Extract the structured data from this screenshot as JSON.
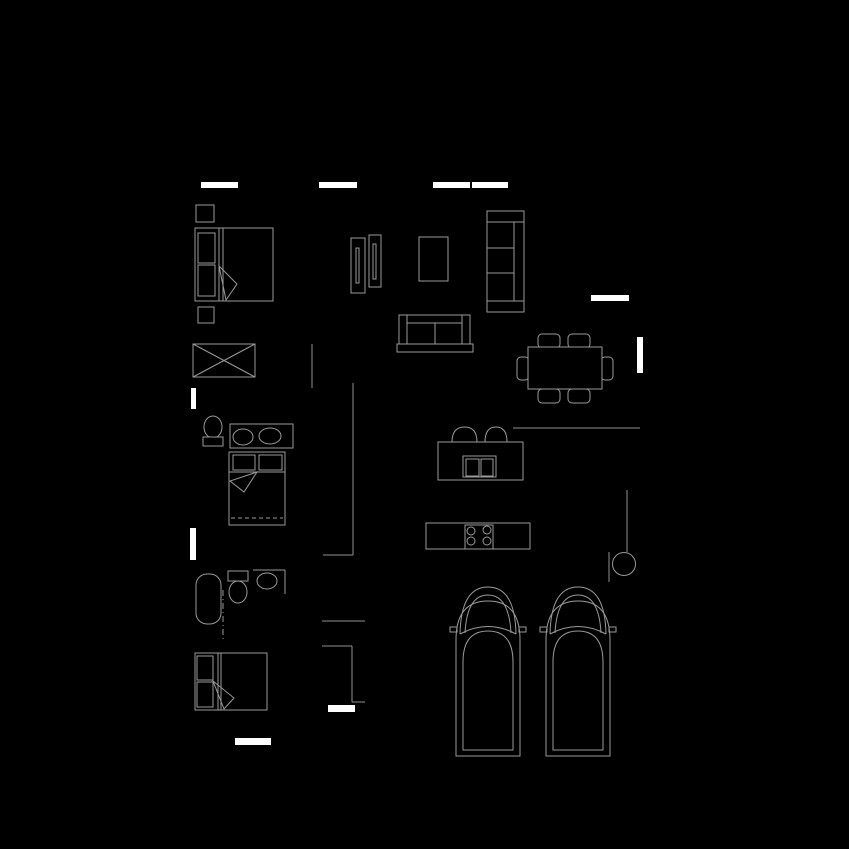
{
  "canvas": {
    "w": 849,
    "h": 849,
    "bg": "#000000"
  },
  "palette": {
    "wall_line": "#8f8f8f",
    "furniture_line": "#9a9a9a",
    "window_fill": "#ffffff",
    "occlusion_fill": "#000000"
  },
  "layers": [
    {
      "name": "walls",
      "stroke": "#8f8f8f",
      "items": [
        {
          "kind": "line",
          "name": "wall-bedroom1-stub",
          "x1": 312,
          "y1": 344,
          "x2": 312,
          "y2": 388
        },
        {
          "kind": "line",
          "name": "wall-hall-vertical",
          "x1": 353,
          "y1": 383,
          "x2": 353,
          "y2": 555
        },
        {
          "kind": "line",
          "name": "wall-hall-corner",
          "x1": 323,
          "y1": 555,
          "x2": 353,
          "y2": 555
        },
        {
          "kind": "line",
          "name": "wall-hall-lower-1",
          "x1": 322,
          "y1": 621,
          "x2": 365,
          "y2": 621
        },
        {
          "kind": "line",
          "name": "wall-hall-lower-2",
          "x1": 322,
          "y1": 646,
          "x2": 352,
          "y2": 646
        },
        {
          "kind": "line",
          "name": "wall-hall-lower-3",
          "x1": 352,
          "y1": 646,
          "x2": 352,
          "y2": 702
        },
        {
          "kind": "line",
          "name": "wall-hall-lower-4",
          "x1": 352,
          "y1": 702,
          "x2": 365,
          "y2": 702
        },
        {
          "kind": "line",
          "name": "wall-dining-bottom",
          "x1": 513,
          "y1": 428,
          "x2": 640,
          "y2": 428
        },
        {
          "kind": "line",
          "name": "wall-utility-vertical",
          "x1": 627,
          "y1": 490,
          "x2": 627,
          "y2": 552
        },
        {
          "kind": "line",
          "name": "wall-utility-short",
          "x1": 609,
          "y1": 552,
          "x2": 609,
          "y2": 582
        }
      ]
    },
    {
      "name": "furniture",
      "stroke": "#9a9a9a",
      "items": [
        {
          "kind": "rect",
          "name": "nightstand-1",
          "x": 196,
          "y": 205,
          "w": 18,
          "h": 17
        },
        {
          "kind": "rect",
          "name": "master-bed-frame",
          "x": 195,
          "y": 228,
          "w": 78,
          "h": 73,
          "fill": "dark"
        },
        {
          "kind": "rect",
          "name": "master-bed-pillow-1",
          "x": 198,
          "y": 233,
          "w": 17,
          "h": 30
        },
        {
          "kind": "rect",
          "name": "master-bed-pillow-2",
          "x": 198,
          "y": 265,
          "w": 17,
          "h": 31
        },
        {
          "kind": "line",
          "name": "master-bed-blanket-line-1",
          "x1": 219,
          "y1": 228,
          "x2": 219,
          "y2": 301
        },
        {
          "kind": "line",
          "name": "master-bed-blanket-line-2",
          "x1": 223,
          "y1": 228,
          "x2": 223,
          "y2": 301
        },
        {
          "kind": "polygon",
          "name": "master-bed-fold",
          "points": "219,266 237,284 226,300"
        },
        {
          "kind": "rect",
          "name": "nightstand-2",
          "x": 198,
          "y": 307,
          "w": 16,
          "h": 16
        },
        {
          "kind": "rect",
          "name": "wardrobe",
          "x": 193,
          "y": 344,
          "w": 62,
          "h": 33
        },
        {
          "kind": "line",
          "name": "wardrobe-diagonal-1",
          "x1": 193,
          "y1": 344,
          "x2": 255,
          "y2": 377
        },
        {
          "kind": "line",
          "name": "wardrobe-diagonal-2",
          "x1": 255,
          "y1": 344,
          "x2": 193,
          "y2": 377
        },
        {
          "kind": "rect",
          "name": "media-panel-1",
          "x": 351,
          "y": 238,
          "w": 14,
          "h": 55
        },
        {
          "kind": "rect",
          "name": "media-panel-1-slit",
          "x": 356,
          "y": 248,
          "w": 3,
          "h": 35
        },
        {
          "kind": "rect",
          "name": "media-panel-2",
          "x": 369,
          "y": 235,
          "w": 12,
          "h": 52
        },
        {
          "kind": "rect",
          "name": "media-panel-2-slit",
          "x": 373,
          "y": 244,
          "w": 3,
          "h": 35
        },
        {
          "kind": "rect",
          "name": "armchair-table",
          "x": 419,
          "y": 237,
          "w": 29,
          "h": 44
        },
        {
          "kind": "rect",
          "name": "sofa-horizontal-base",
          "x": 397,
          "y": 344,
          "w": 76,
          "h": 8
        },
        {
          "kind": "rect",
          "name": "sofa-horizontal-body",
          "x": 399,
          "y": 315,
          "w": 71,
          "h": 29,
          "fill": "dark"
        },
        {
          "kind": "line",
          "name": "sofa-horizontal-arm-left",
          "x1": 407,
          "y1": 315,
          "x2": 407,
          "y2": 344
        },
        {
          "kind": "line",
          "name": "sofa-horizontal-arm-right",
          "x1": 462,
          "y1": 315,
          "x2": 462,
          "y2": 344
        },
        {
          "kind": "line",
          "name": "sofa-horizontal-backline",
          "x1": 407,
          "y1": 323,
          "x2": 462,
          "y2": 323
        },
        {
          "kind": "line",
          "name": "sofa-horizontal-cushion-divider",
          "x1": 435,
          "y1": 323,
          "x2": 435,
          "y2": 344
        },
        {
          "kind": "rect",
          "name": "sofa-vertical-body",
          "x": 487,
          "y": 211,
          "w": 37,
          "h": 101,
          "fill": "dark"
        },
        {
          "kind": "line",
          "name": "sofa-vertical-arm-top",
          "x1": 487,
          "y1": 222,
          "x2": 524,
          "y2": 222
        },
        {
          "kind": "line",
          "name": "sofa-vertical-arm-bottom",
          "x1": 487,
          "y1": 301,
          "x2": 524,
          "y2": 301
        },
        {
          "kind": "line",
          "name": "sofa-vertical-backline",
          "x1": 514,
          "y1": 222,
          "x2": 514,
          "y2": 301
        },
        {
          "kind": "line",
          "name": "sofa-vertical-cushion-1",
          "x1": 487,
          "y1": 248,
          "x2": 514,
          "y2": 248
        },
        {
          "kind": "line",
          "name": "sofa-vertical-cushion-2",
          "x1": 487,
          "y1": 273,
          "x2": 514,
          "y2": 273
        },
        {
          "kind": "rect",
          "name": "dining-chair-top-1",
          "x": 538,
          "y": 334,
          "w": 22,
          "h": 14,
          "rx": 4
        },
        {
          "kind": "rect",
          "name": "dining-chair-top-2",
          "x": 568,
          "y": 334,
          "w": 22,
          "h": 14,
          "rx": 4
        },
        {
          "kind": "rect",
          "name": "dining-chair-bottom-1",
          "x": 538,
          "y": 389,
          "w": 22,
          "h": 14,
          "rx": 4
        },
        {
          "kind": "rect",
          "name": "dining-chair-bottom-2",
          "x": 568,
          "y": 389,
          "w": 22,
          "h": 14,
          "rx": 4
        },
        {
          "kind": "rect",
          "name": "dining-chair-left",
          "x": 517,
          "y": 357,
          "w": 12,
          "h": 23,
          "rx": 4
        },
        {
          "kind": "rect",
          "name": "dining-chair-right",
          "x": 601,
          "y": 357,
          "w": 12,
          "h": 23,
          "rx": 4
        },
        {
          "kind": "rect",
          "name": "dining-table",
          "x": 528,
          "y": 347,
          "w": 74,
          "h": 42,
          "fill": "dark"
        },
        {
          "kind": "ellipse",
          "name": "toilet-2-bowl",
          "cx": 213,
          "cy": 427,
          "rx": 9,
          "ry": 11
        },
        {
          "kind": "rect",
          "name": "toilet-2-tank",
          "x": 203,
          "y": 437,
          "w": 20,
          "h": 9,
          "fill": "dark"
        },
        {
          "kind": "rect",
          "name": "vanity-counter",
          "x": 230,
          "y": 424,
          "w": 63,
          "h": 24
        },
        {
          "kind": "ellipse",
          "name": "vanity-sink-1",
          "cx": 243,
          "cy": 437,
          "rx": 10,
          "ry": 8
        },
        {
          "kind": "ellipse",
          "name": "vanity-sink-2",
          "cx": 270,
          "cy": 436,
          "rx": 11,
          "ry": 8
        },
        {
          "kind": "rect",
          "name": "bed2-frame",
          "x": 229,
          "y": 452,
          "w": 56,
          "h": 73,
          "fill": "dark"
        },
        {
          "kind": "rect",
          "name": "bed2-pillow-1",
          "x": 233,
          "y": 455,
          "w": 22,
          "h": 15
        },
        {
          "kind": "rect",
          "name": "bed2-pillow-2",
          "x": 259,
          "y": 455,
          "w": 23,
          "h": 15
        },
        {
          "kind": "line",
          "name": "bed2-blanket-line",
          "x1": 229,
          "y1": 472,
          "x2": 285,
          "y2": 472
        },
        {
          "kind": "polygon",
          "name": "bed2-fold",
          "points": "257,472 230,481 244,492"
        },
        {
          "kind": "line",
          "name": "bed2-hem-dashed",
          "x1": 231,
          "y1": 518,
          "x2": 283,
          "y2": 518,
          "dash": "4 3"
        },
        {
          "kind": "rect",
          "name": "bathtub",
          "x": 196,
          "y": 574,
          "w": 25,
          "h": 50,
          "rx": 11
        },
        {
          "kind": "line",
          "name": "bathroom-divider",
          "x1": 223,
          "y1": 590,
          "x2": 223,
          "y2": 640,
          "dash": "6 3 1 3"
        },
        {
          "kind": "rect",
          "name": "toilet-3-tank",
          "x": 228,
          "y": 571,
          "w": 20,
          "h": 10
        },
        {
          "kind": "ellipse",
          "name": "toilet-3-bowl",
          "cx": 238,
          "cy": 592,
          "rx": 9,
          "ry": 11
        },
        {
          "kind": "line",
          "name": "corner-sink-counter-top",
          "x1": 253,
          "y1": 570,
          "x2": 285,
          "y2": 570
        },
        {
          "kind": "line",
          "name": "corner-sink-counter-side",
          "x1": 285,
          "y1": 570,
          "x2": 285,
          "y2": 594
        },
        {
          "kind": "ellipse",
          "name": "corner-sink-basin",
          "cx": 267,
          "cy": 581,
          "rx": 10,
          "ry": 8
        },
        {
          "kind": "rect",
          "name": "bed3-frame",
          "x": 195,
          "y": 653,
          "w": 72,
          "h": 57,
          "fill": "dark"
        },
        {
          "kind": "rect",
          "name": "bed3-pillow-1",
          "x": 197,
          "y": 656,
          "w": 16,
          "h": 24
        },
        {
          "kind": "rect",
          "name": "bed3-pillow-2",
          "x": 197,
          "y": 682,
          "w": 16,
          "h": 25
        },
        {
          "kind": "line",
          "name": "bed3-blanket-line-1",
          "x1": 218,
          "y1": 653,
          "x2": 218,
          "y2": 710
        },
        {
          "kind": "line",
          "name": "bed3-blanket-line-2",
          "x1": 221,
          "y1": 653,
          "x2": 221,
          "y2": 710
        },
        {
          "kind": "polygon",
          "name": "bed3-fold",
          "points": "213,681 234,698 224,709"
        },
        {
          "kind": "path",
          "name": "bar-stool-1",
          "d": "M452,442 Q452,427 464.5,427 Q477,427 477,442"
        },
        {
          "kind": "path",
          "name": "bar-stool-2",
          "d": "M485,442 Q485,427 496,427 Q507,427 507,442"
        },
        {
          "kind": "rect",
          "name": "kitchen-island",
          "x": 438,
          "y": 442,
          "w": 85,
          "h": 38,
          "fill": "dark"
        },
        {
          "kind": "rect",
          "name": "island-sink-outer",
          "x": 463,
          "y": 456,
          "w": 33,
          "h": 21
        },
        {
          "kind": "rect",
          "name": "island-sink-basin-1",
          "x": 466,
          "y": 459,
          "w": 13,
          "h": 17
        },
        {
          "kind": "rect",
          "name": "island-sink-basin-2",
          "x": 481,
          "y": 459,
          "w": 12,
          "h": 17
        },
        {
          "kind": "rect",
          "name": "kitchen-counter",
          "x": 426,
          "y": 523,
          "w": 104,
          "h": 26
        },
        {
          "kind": "rect",
          "name": "cooktop",
          "x": 465,
          "y": 525,
          "w": 28,
          "h": 24
        },
        {
          "kind": "circle",
          "name": "burner-1",
          "cx": 471,
          "cy": 531,
          "r": 4
        },
        {
          "kind": "circle",
          "name": "burner-2",
          "cx": 487,
          "cy": 530,
          "r": 4
        },
        {
          "kind": "circle",
          "name": "burner-3",
          "cx": 471,
          "cy": 541,
          "r": 4
        },
        {
          "kind": "circle",
          "name": "burner-4",
          "cx": 487,
          "cy": 541,
          "r": 4
        },
        {
          "kind": "circle",
          "name": "water-heater",
          "cx": 624,
          "cy": 564,
          "r": 11.5
        },
        {
          "kind": "path",
          "name": "car-1-body",
          "d": "M456,756 L456,640 Q456,601 488,601 Q520,601 520,640 L520,756 Z"
        },
        {
          "kind": "path",
          "name": "car-1-cabin",
          "d": "M463,750 L463,662 Q463,631 488,631 Q513,631 513,662 L513,750 Z"
        },
        {
          "kind": "path",
          "name": "car-1-windshield-outer",
          "d": "M460,634 Q461,587 488,587 Q515,587 516,634"
        },
        {
          "kind": "path",
          "name": "car-1-windshield-inner",
          "d": "M465,633 Q467,595 488,595 Q509,595 511,633"
        },
        {
          "kind": "path",
          "name": "car-1-hood-line",
          "d": "M460,634 Q488,619 516,634"
        },
        {
          "kind": "rect",
          "name": "car-1-mirror-left",
          "x": 450,
          "y": 627,
          "w": 7,
          "h": 5
        },
        {
          "kind": "rect",
          "name": "car-1-mirror-right",
          "x": 519,
          "y": 627,
          "w": 7,
          "h": 5
        },
        {
          "kind": "path",
          "name": "car-2-body",
          "d": "M546,756 L546,640 Q546,601 578,601 Q610,601 610,640 L610,756 Z"
        },
        {
          "kind": "path",
          "name": "car-2-cabin",
          "d": "M553,750 L553,662 Q553,631 578,631 Q603,631 603,662 L603,750 Z"
        },
        {
          "kind": "path",
          "name": "car-2-windshield-outer",
          "d": "M550,634 Q551,587 578,587 Q605,587 606,634"
        },
        {
          "kind": "path",
          "name": "car-2-windshield-inner",
          "d": "M555,633 Q557,595 578,595 Q599,595 601,633"
        },
        {
          "kind": "path",
          "name": "car-2-hood-line",
          "d": "M550,634 Q578,619 606,634"
        },
        {
          "kind": "rect",
          "name": "car-2-mirror-left",
          "x": 540,
          "y": 627,
          "w": 7,
          "h": 5
        },
        {
          "kind": "rect",
          "name": "car-2-mirror-right",
          "x": 609,
          "y": 627,
          "w": 7,
          "h": 5
        }
      ]
    },
    {
      "name": "windows",
      "stroke": "none",
      "items": [
        {
          "kind": "rect",
          "name": "window-top-1",
          "x": 201,
          "y": 182,
          "w": 37,
          "h": 6,
          "fill": "window"
        },
        {
          "kind": "rect",
          "name": "window-top-2",
          "x": 319,
          "y": 182,
          "w": 38,
          "h": 6,
          "fill": "window"
        },
        {
          "kind": "rect",
          "name": "window-top-3",
          "x": 433,
          "y": 182,
          "w": 37,
          "h": 6,
          "fill": "window"
        },
        {
          "kind": "rect",
          "name": "window-top-4",
          "x": 472,
          "y": 182,
          "w": 36,
          "h": 6,
          "fill": "window"
        },
        {
          "kind": "rect",
          "name": "window-right-horizontal",
          "x": 591,
          "y": 295,
          "w": 38,
          "h": 6,
          "fill": "window"
        },
        {
          "kind": "rect",
          "name": "window-right-vertical",
          "x": 637,
          "y": 337,
          "w": 6,
          "h": 36,
          "fill": "window"
        },
        {
          "kind": "rect",
          "name": "window-left-1",
          "x": 191,
          "y": 388,
          "w": 5,
          "h": 21,
          "fill": "window"
        },
        {
          "kind": "rect",
          "name": "window-left-2",
          "x": 190,
          "y": 528,
          "w": 6,
          "h": 32,
          "fill": "window"
        },
        {
          "kind": "rect",
          "name": "door-bottom-1",
          "x": 328,
          "y": 705,
          "w": 27,
          "h": 7,
          "fill": "window"
        },
        {
          "kind": "rect",
          "name": "door-bottom-2",
          "x": 235,
          "y": 738,
          "w": 36,
          "h": 7,
          "fill": "window"
        }
      ]
    }
  ]
}
